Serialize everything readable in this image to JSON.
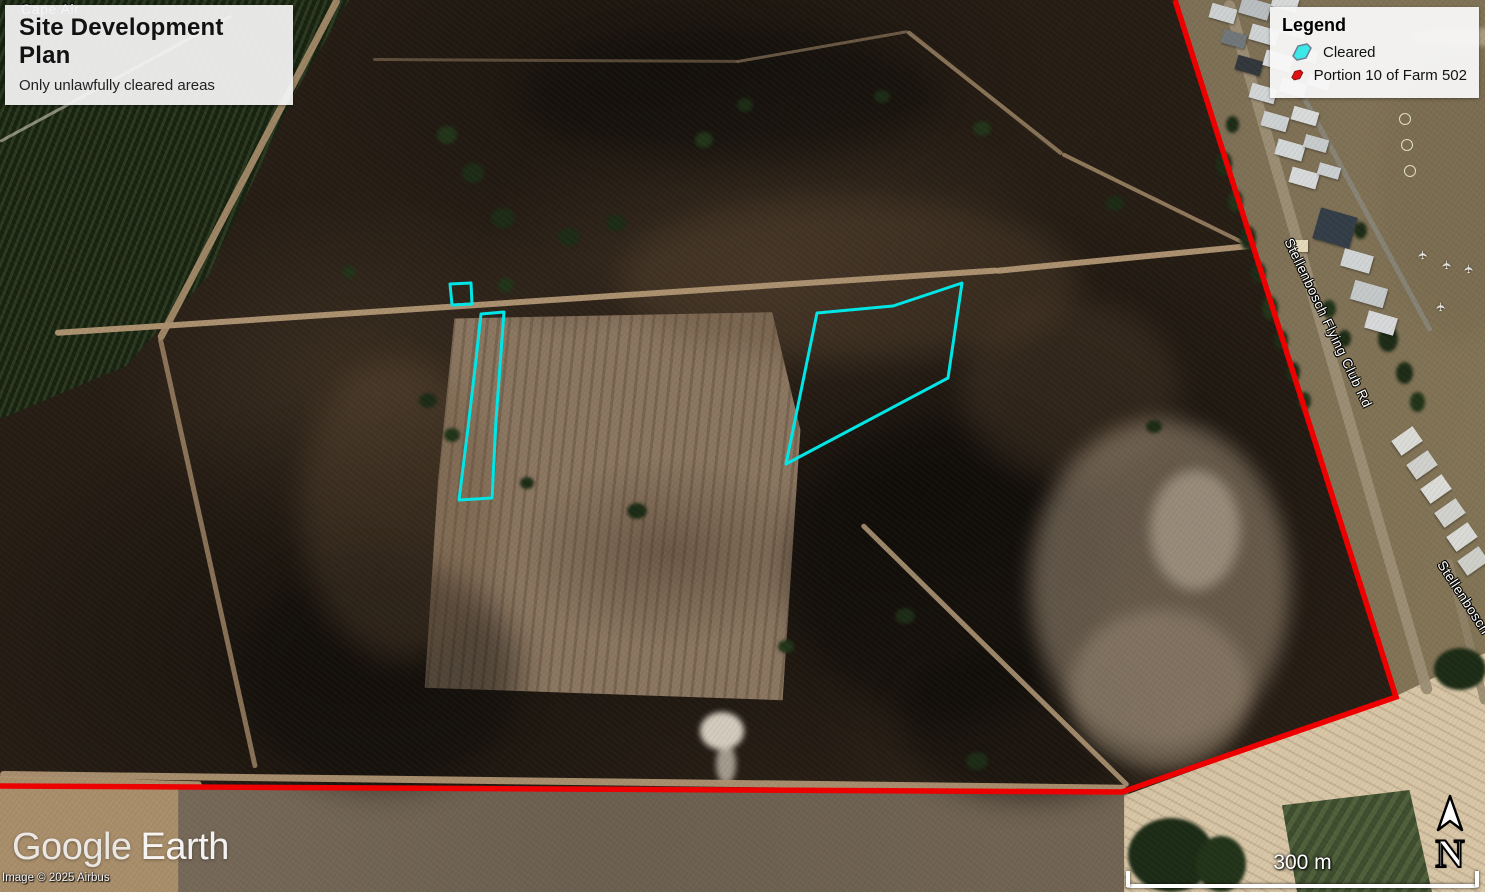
{
  "title_box": {
    "title": "Site Development Plan",
    "subtitle": "Only unlawfully cleared areas"
  },
  "legend": {
    "heading": "Legend",
    "items": [
      {
        "label": "Cleared",
        "color": "#3ae8e8",
        "outline": "#6b7f8f"
      },
      {
        "label": "Portion 10 of Farm 502",
        "color": "#e01010",
        "outline": "#7e1010"
      }
    ]
  },
  "map_labels": {
    "road_primary": "Stellenbosch Flying Club Rd",
    "road_secondary": "Stellenbosch",
    "poi_airport": "Cape Air",
    "poi_icon": "airplane-icon"
  },
  "overlays": {
    "cleared_color": "#00e6e6",
    "boundary": {
      "label": "Portion 10 of Farm 502",
      "color": "#ec0000",
      "points": "1175,0 1396,697 1122,792 0,786"
    },
    "cleared": [
      {
        "points": "450,284 471,283 472,304 452,305"
      },
      {
        "points": "481,314 504,312 496,420 492,498 459,500 468,428 476,360"
      },
      {
        "points": "817,313 893,306 962,283 948,378 786,464"
      }
    ]
  },
  "north_indicator": {
    "label": "N"
  },
  "scale_bar": {
    "label": "300 m"
  },
  "attribution": {
    "logo_word1": "Google",
    "logo_word2": "Earth",
    "copyright": "Image © 2025 Airbus"
  }
}
